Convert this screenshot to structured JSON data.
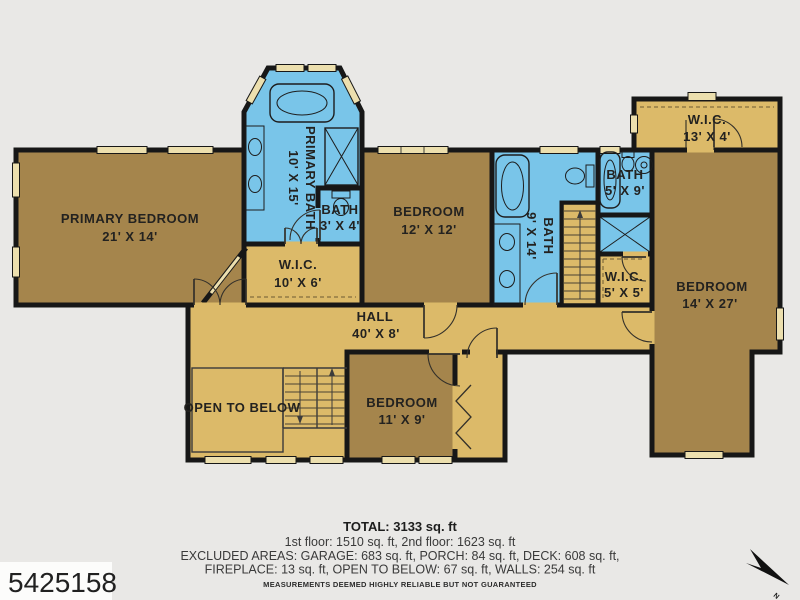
{
  "rooms": {
    "primary_bedroom": {
      "name": "PRIMARY BEDROOM",
      "dims": "21' X 14'"
    },
    "primary_bath": {
      "name": "PRIMARY BATH",
      "dims": "10' X 15'"
    },
    "bath_3x4": {
      "name": "BATH",
      "dims": "3' X 4'"
    },
    "wic_10x6": {
      "name": "W.I.C.",
      "dims": "10' X 6'"
    },
    "bedroom_12x12": {
      "name": "BEDROOM",
      "dims": "12' X 12'"
    },
    "bath_9x14": {
      "name": "BATH",
      "dims": "9' X 14'"
    },
    "bath_5x9": {
      "name": "BATH",
      "dims": "5' X 9'"
    },
    "wic_5x5": {
      "name": "W.I.C.",
      "dims": "5' X 5'"
    },
    "wic_13x4": {
      "name": "W.I.C.",
      "dims": "13' X 4'"
    },
    "bedroom_14x27": {
      "name": "BEDROOM",
      "dims": "14' X 27'"
    },
    "hall": {
      "name": "HALL",
      "dims": "40' X 8'"
    },
    "open_to_below": {
      "name": "OPEN TO BELOW"
    },
    "bedroom_11x9": {
      "name": "BEDROOM",
      "dims": "11' X 9'"
    }
  },
  "footer": {
    "total": "TOTAL: 3133 sq. ft",
    "floors": "1st floor: 1510 sq. ft, 2nd floor: 1623 sq. ft",
    "excluded1": "EXCLUDED AREAS: GARAGE: 683 sq. ft, PORCH: 84 sq. ft, DECK: 608 sq. ft,",
    "excluded2": "FIREPLACE: 13 sq. ft, OPEN TO BELOW: 67 sq. ft, WALLS: 254 sq. ft",
    "disclaimer": "MEASUREMENTS DEEMED HIGHLY RELIABLE BUT NOT GUARANTEED"
  },
  "badge": {
    "mls_number": "5425158"
  },
  "compass": {
    "label": "N"
  },
  "colors": {
    "background": "#e9e8e6",
    "room_brown": "#a5854c",
    "room_tan": "#dcba69",
    "bath_blue": "#79c5e9",
    "wall": "#171717",
    "opening": "#ecdfae"
  }
}
